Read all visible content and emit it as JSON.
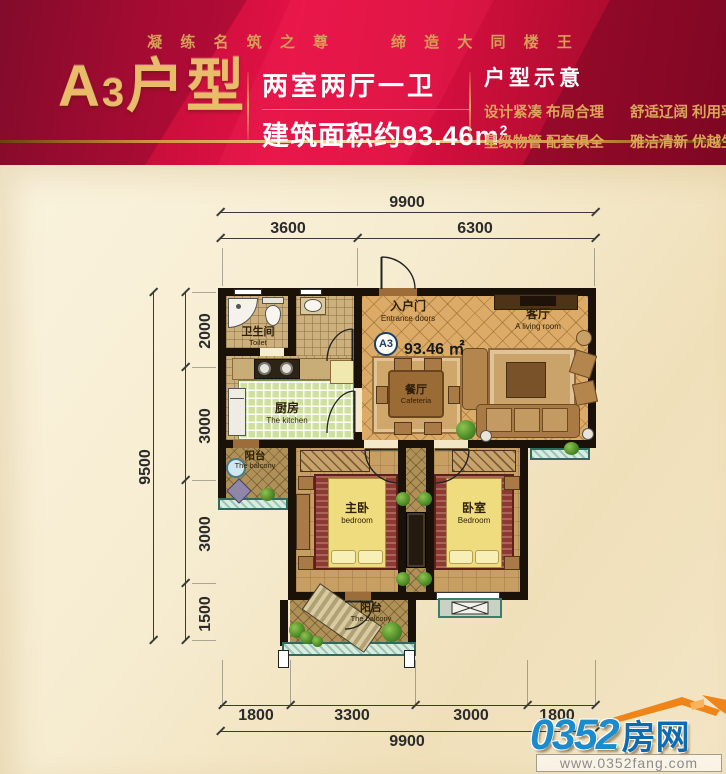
{
  "header": {
    "slogan_left": "凝 练 名 筑 之 尊",
    "slogan_right": "缔 造 大 同 楼 王",
    "title_a": "A",
    "title_num": "3",
    "title_suffix": "户型",
    "layout_line": "两室两厅一卫",
    "area_line": "建筑面积约93.46m",
    "area_sup": "2",
    "section_title": "户型示意",
    "feature_1a": "设计紧凑 布局合理",
    "feature_1b": "舒适辽阔 利用率高",
    "feature_2a": "星级物管 配套俱全",
    "feature_2b": "雅洁清新 优越生活"
  },
  "plan": {
    "badge": "A3",
    "area": "93.46 ㎡",
    "rooms": {
      "entrance": {
        "cn": "入户门",
        "en": "Entrance doors"
      },
      "living": {
        "cn": "客厅",
        "en": "A living room"
      },
      "dining": {
        "cn": "餐厅",
        "en": "Cafeteria"
      },
      "toilet": {
        "cn": "卫生间",
        "en": "Toilet"
      },
      "kitchen": {
        "cn": "厨房",
        "en": "The kitchen"
      },
      "balcony_side": {
        "cn": "阳台",
        "en": "The balcony"
      },
      "master_bedroom": {
        "cn": "主卧",
        "en": "bedroom"
      },
      "second_bedroom": {
        "cn": "卧室",
        "en": "Bedroom"
      },
      "balcony_bottom": {
        "cn": "阳台",
        "en": "The balcony"
      }
    }
  },
  "dims": {
    "top_total": "9900",
    "top_seg_1": "3600",
    "top_seg_2": "6300",
    "left_total": "9500",
    "left_seg_1": "2000",
    "left_seg_2": "3000",
    "left_seg_3": "3000",
    "left_seg_4": "1500",
    "bottom_seg_1": "1800",
    "bottom_seg_2": "3300",
    "bottom_seg_3": "3000",
    "bottom_seg_4": "1800",
    "bottom_total": "9900"
  },
  "footer": {
    "logo_number": "0352",
    "logo_name": "房网",
    "logo_url": "www.0352fang.com"
  },
  "colors": {
    "band_red": "#d30f3f",
    "gold": "#d7a257",
    "wall": "#1a1108",
    "floor_tan": "#dcab67",
    "kitchen_green": "#cfdf9e",
    "window_teal": "#2e6b5e",
    "logo_blue": "#0e6cae",
    "logo_orange": "#ef8418"
  }
}
